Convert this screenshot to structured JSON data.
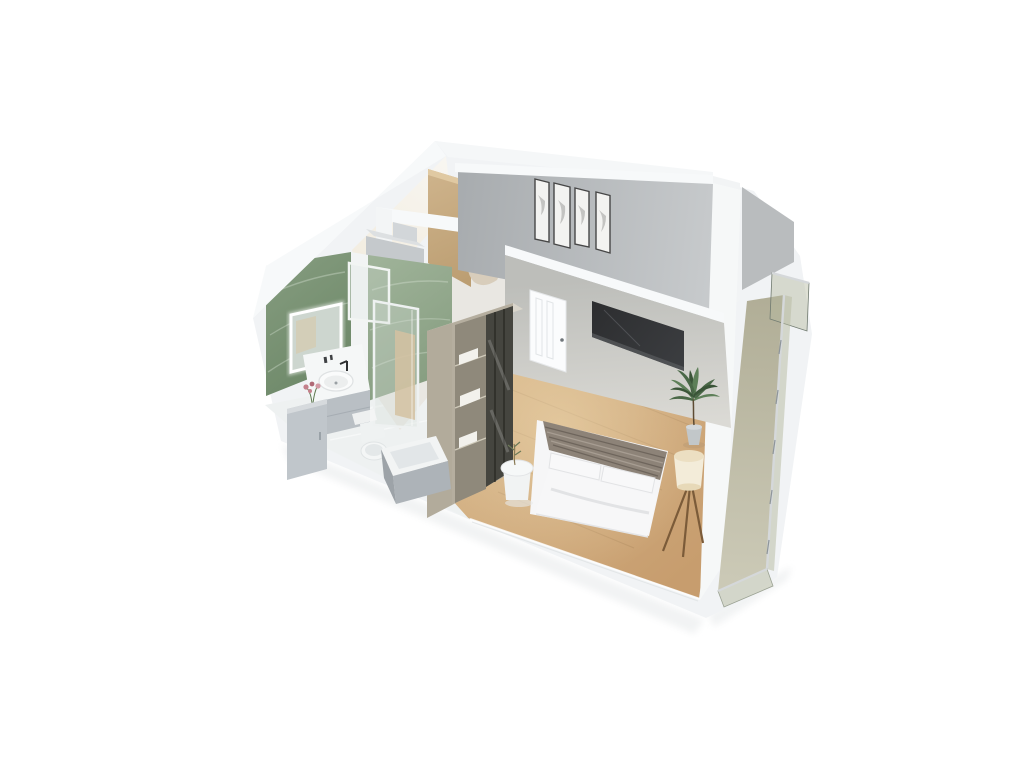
{
  "scene": {
    "view": "isometric-3d-floor-plan-render",
    "background": "#ffffff"
  },
  "colors": {
    "background": "#ffffff",
    "slab_white": "#f1f3f5",
    "wall_top_band": "#f7f9fa",
    "shadow_soft": "#edeff0",
    "entry_wall_warm": "#f2ecdf",
    "wood_panel": "#cdb28a",
    "wood_panel_dark": "#bc9e72",
    "green_marble_dark": "#6d8868",
    "green_marble_mid": "#859c7f",
    "green_marble_light": "#9fb399",
    "marble_vein": "#e9f1e6",
    "hall_floor": "#e9e7e2",
    "box_gray_front": "#c5c9cc",
    "box_gray_top": "#dde0e2",
    "armchair_beige": "#d8cdbb",
    "back_wall_dark": "#a8acaf",
    "back_wall_light": "#c7cacc",
    "side_panel_gray": "#b9bcbe",
    "frame_border": "#474747",
    "frame_fill": "#f3f3f1",
    "frame_smudge": "#9c9c9a",
    "tv_wall_top": "#bdbeba",
    "tv_wall_bottom": "#dbdad5",
    "niche_dark": "#2c2d2f",
    "niche_light": "#55575a",
    "door_white": "#fbfcfd",
    "door_line": "#e2e5e7",
    "handle_gray": "#70767b",
    "right_wall_white": "#f6f8f8",
    "wood_floor_light": "#d9ba8e",
    "wood_floor_dark": "#c79d6e",
    "wood_floor_hot": "#f0dcb4",
    "plank_line": "#8a6a42",
    "wardrobe_side": "#b2ab9b",
    "wardrobe_top": "#d9d5cb",
    "wardrobe_frame": "#b5ae9f",
    "shelf_bg": "#8f897b",
    "shelf_line": "#cfcaba",
    "linen_white": "#f2f1ec",
    "glass_door_dark": "#45453f",
    "glass_mullion": "#26261f",
    "bed_white": "#f6f6f7",
    "bed_shadow": "#d9dadc",
    "blanket_taupe": "#8d8378",
    "blanket_stripe": "#6e655c",
    "blanket_stripe_light": "#a79d92",
    "table_white": "#f1f3f3",
    "lamp_shade": "#f3ecd9",
    "lamp_top": "#ecdfc2",
    "lamp_leg_wood": "#7b5b39",
    "plant_green": "#4a6847",
    "plant_green_light": "#5d7f58",
    "plant_green_dark": "#3a5438",
    "pot_gray": "#c2c7c9",
    "trunk_brown": "#5d4b33",
    "bath_floor": "#eef1f1",
    "mirror_glass": "#cdd6cf",
    "mirror_warm": "#d8c8a6",
    "counter_white": "#f5f7f7",
    "vanity_gray": "#b9bfc4",
    "cabinet_gray": "#c0c6cb",
    "sink_white": "#fafbfb",
    "faucet_black": "#2e2f31",
    "flower_pink": "#c4808b",
    "toilet_white": "#f4f6f6",
    "tub_panel": "#adb3b8",
    "tub_side": "#9da3a8",
    "tub_inner": "#e2e6e8",
    "shower_frame": "#eef1f1",
    "balcony_floor_dark": "#b1ae97",
    "balcony_floor_light": "#cbc9b6",
    "rail_metal": "#8e959a",
    "rail_light": "#d5d8da"
  },
  "rooms": [
    {
      "name": "entry-hall",
      "features": [
        "wood-accent-wall",
        "storage-boxes",
        "armchair"
      ]
    },
    {
      "name": "bathroom",
      "features": [
        "green-marble-walls",
        "led-mirror",
        "glass-partition",
        "vessel-sink-vanity",
        "flower-vase",
        "storage-cabinet",
        "toilet",
        "bathtub",
        "glass-shower-door",
        "bath-mat"
      ]
    },
    {
      "name": "living-bedroom",
      "features": [
        "gallery-wall-four-frames",
        "tv-niche",
        "white-paneled-door",
        "wardrobe-glass-doors",
        "double-bed",
        "round-side-table",
        "tripod-floor-lamp",
        "potted-plant",
        "wood-floor"
      ]
    },
    {
      "name": "balcony",
      "features": [
        "glass-balustrade",
        "metal-posts",
        "olive-glass-panels"
      ]
    }
  ]
}
